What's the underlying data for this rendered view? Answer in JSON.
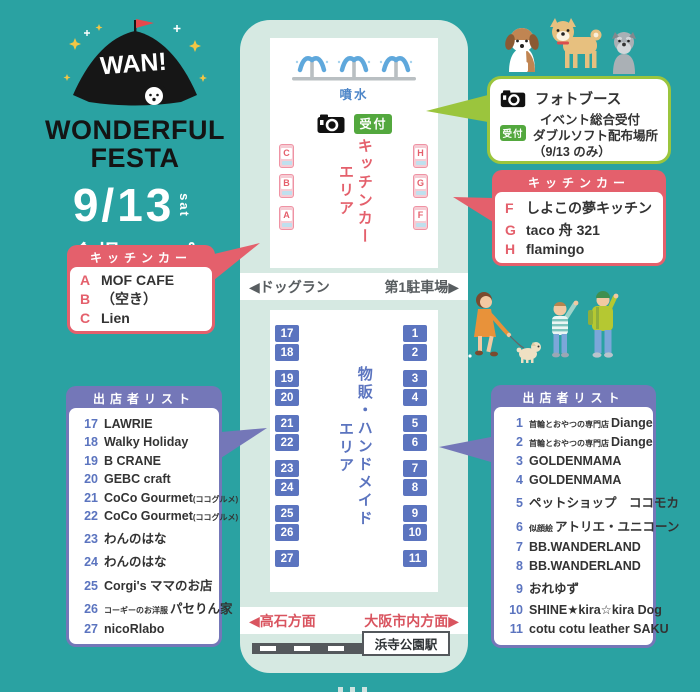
{
  "logo": {
    "wan": "WAN!",
    "title_line1": "WONDERFUL",
    "title_line2": "FESTA",
    "date": "9/13",
    "date_day": "sat",
    "map_label": "会場マップ"
  },
  "map": {
    "fountain_label": "噴水",
    "reception_label": "受付",
    "kitchen_area_line1": "キッチンカー",
    "kitchen_area_line2": "エリア",
    "trucks_left": [
      "C",
      "B",
      "A"
    ],
    "trucks_right": [
      "H",
      "G",
      "F"
    ],
    "dogrun_left": "◀ドッグラン",
    "dogrun_right": "第1駐車場▶",
    "handmade_line1": "物販・ハンドメイド",
    "handmade_line2": "エリア",
    "stalls_left": [
      "17",
      "18",
      "19",
      "20",
      "21",
      "22",
      "23",
      "24",
      "25",
      "26",
      "27"
    ],
    "stalls_right": [
      "1",
      "2",
      "3",
      "4",
      "5",
      "6",
      "7",
      "8",
      "9",
      "10",
      "11"
    ],
    "direction_left": "◀高石方面",
    "direction_right": "大阪市内方面▶",
    "station": "浜寺公園駅"
  },
  "photobooth": {
    "title": "フォトブース",
    "badge": "受付",
    "line1": "イベント総合受付",
    "line2": "ダブルソフト配布場所",
    "line3": "（9/13 のみ）"
  },
  "kitchen_left": {
    "header": "キッチンカー",
    "items": [
      {
        "letter": "A",
        "name": "MOF CAFE"
      },
      {
        "letter": "B",
        "name": "（空き）"
      },
      {
        "letter": "C",
        "name": "Lien"
      }
    ]
  },
  "kitchen_right": {
    "header": "キッチンカー",
    "items": [
      {
        "letter": "F",
        "name": "しよこの夢キッチン"
      },
      {
        "letter": "G",
        "name": "taco 舟 321"
      },
      {
        "letter": "H",
        "name": "flamingo"
      }
    ]
  },
  "vendors_left": {
    "header": "出店者リスト",
    "items": [
      {
        "num": "17",
        "name": "LAWRIE"
      },
      {
        "num": "18",
        "name": "Walky Holiday"
      },
      {
        "num": "19",
        "name": "B CRANE"
      },
      {
        "num": "20",
        "name": "GEBC craft"
      },
      {
        "num": "21",
        "name": "CoCo Gourmet",
        "suf": "(ココグルメ)"
      },
      {
        "num": "22",
        "name": "CoCo Gourmet",
        "suf": "(ココグルメ)"
      },
      {
        "num": "23",
        "name": "わんのはな"
      },
      {
        "num": "24",
        "name": "わんのはな"
      },
      {
        "num": "25",
        "name": "Corgi's ママのお店"
      },
      {
        "num": "26",
        "pre": "コーギーのお洋服",
        "name": "パセりん家"
      },
      {
        "num": "27",
        "name": "nicoRlabo"
      }
    ]
  },
  "vendors_right": {
    "header": "出店者リスト",
    "items": [
      {
        "num": "1",
        "pre": "首輪とおやつの専門店",
        "name": "Diange"
      },
      {
        "num": "2",
        "pre": "首輪とおやつの専門店",
        "name": "Diange"
      },
      {
        "num": "3",
        "name": "GOLDENMAMA"
      },
      {
        "num": "4",
        "name": "GOLDENMAMA"
      },
      {
        "num": "5",
        "name": "ペットショップ　ココモカ"
      },
      {
        "num": "6",
        "pre": "似顔絵",
        "name": "アトリエ・ユニコーン"
      },
      {
        "num": "7",
        "name": "BB.WANDERLAND"
      },
      {
        "num": "8",
        "name": "BB.WANDERLAND"
      },
      {
        "num": "9",
        "name": "おれゆず"
      },
      {
        "num": "10",
        "name": "SHINE★kira☆kira Dog"
      },
      {
        "num": "11",
        "name": "cotu cotu leather SAKU"
      }
    ]
  },
  "icons": {
    "tent": "festa-tent-logo-icon",
    "fountain": "fountain-icon",
    "camera": "camera-icon",
    "dogs": "three-dogs-illustration",
    "people": "people-walking-dog-illustration"
  },
  "colors": {
    "background": "#2aa2a2",
    "panel": "#d6e9e2",
    "pink": "#e4606c",
    "stall_blue": "#5b74bf",
    "list_purple": "#7477b8",
    "reception_green": "#53a83e",
    "callout_green": "#9bc53d",
    "direction_red": "#d9545f",
    "fountain_blue": "#5fa8dc"
  }
}
